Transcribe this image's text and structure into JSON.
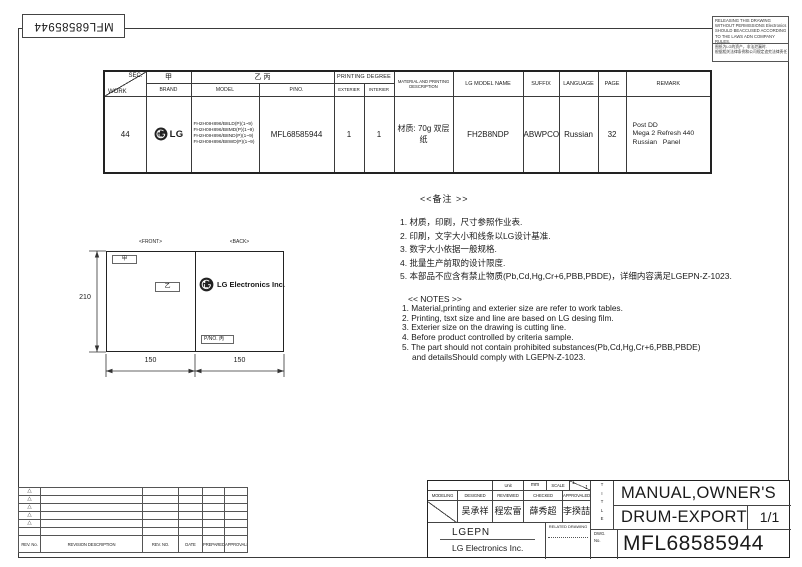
{
  "page": {
    "part_number_top": "MFL68585944"
  },
  "warning_box": {
    "en_lines": [
      "RELEASING THIS DRAWING",
      "WITHOUT PERMISSIONS Electronics",
      "SHOULD BEACCUSED ACCORDING",
      "TO THE LAWS ADN COMPANY",
      "RULES."
    ],
    "cn_lines": [
      "图纸为LG的资产，非法泄漏时.",
      "根据相关法律条例和公司规定追究法律责任"
    ]
  },
  "spec_table": {
    "corner_top": "SEC.",
    "corner_bottom": "WORK",
    "brand_cn": "甲",
    "model_pno_cn": "乙 丙",
    "brand_label": "BRAND",
    "model_label": "MODEL",
    "pno_label": "P/NO.",
    "printing_degree_label": "PRINTING DEGREE",
    "exterier_label": "EXTERIER",
    "interier_label": "INTERIER",
    "material_label": "MATERIAL AND PRINTING DESCRIPTION",
    "lg_model_label": "LG MODEL NAME",
    "suffix_label": "SUFFIX",
    "language_label": "LANGUAGE",
    "page_label": "PAGE",
    "remark_label": "REMARK",
    "row": {
      "work": "44",
      "brand": "LG",
      "models": [
        "FH2H0IH896/B8LD(P)(1~9)",
        "FH2H0IH896/B8MD(P)(1~9)",
        "FH2H0IH896/B8ND(P)(1~9)",
        "FH2H0IH896/B8WD(P)(1~9)"
      ],
      "pno": "MFL68585944",
      "exterier": "1",
      "interier": "1",
      "material": "材质: 70g 双层纸",
      "lg_model_name": "FH2B8NDP",
      "suffix": "ABWPCOM",
      "language": "Russian",
      "page": "32",
      "remark_lines": [
        "Post DD",
        "Mega 2 Refresh 440",
        "Russian   Panel"
      ]
    }
  },
  "diagram": {
    "front_label": "<FRONT>",
    "back_label": "<BACK>",
    "dim_height": "210",
    "dim_width_left": "150",
    "dim_width_right": "150",
    "tag_front_top": "甲",
    "tag_front_mid": "乙",
    "back_company": "LG Electronics Inc.",
    "back_pno": "P/NO. 丙"
  },
  "notes_cn": {
    "title": "<<备注 >>",
    "items": [
      "1.  材质，印刷，尺寸参照作业表.",
      "2.  印刷，文字大小和线条以LG设计基准.",
      "3.  数字大小依据一般规格.",
      "4.  批量生产前取的设计限度.",
      "5.  本部品不应含有禁止物质(Pb,Cd,Hg,Cr+6,PBB,PBDE)，详细内容满足LGEPN-Z-1023."
    ]
  },
  "notes_en": {
    "title": "<< NOTES >>",
    "items": [
      "1. Material,printing and exterier size are refer to work tables.",
      "2. Printing, tsxt  size and line are based on LG desing film.",
      "3. Exterier size on the drawing is cutting line.",
      "4. Before product controlled by criteria sample.",
      "5. The part should not contain prohibited substances(Pb,Cd,Hg,Cr+6,PBB,PBDE)",
      "and detailsShould comply with LGEPN-Z-1023."
    ]
  },
  "revision_table": {
    "marker": "△",
    "headers": [
      "REV. No.",
      "REVISION DESCRIPTION",
      "REV. NO.",
      "DATE",
      "PREPARED",
      "APPROVALED"
    ]
  },
  "title_block": {
    "unit_label": "Unit",
    "unit_value": "mm",
    "scale_label": "SCALE",
    "scale_top": "1",
    "scale_bottom": "1",
    "role_labels": [
      "MODELING",
      "DESIGNED",
      "REVIEWED",
      "CHECKED",
      "APPROVALED"
    ],
    "names": [
      "吴承祥",
      "程宏雷",
      "薛秀超",
      "李揆喆"
    ],
    "company_code": "LGEPN",
    "company_name": "LG Electronics Inc.",
    "related_drawing_label": "RELATED DRAWING",
    "title_label_vertical": [
      "T",
      "I",
      "T",
      "L",
      "E"
    ],
    "dwg_label_line1": "DWG.",
    "dwg_label_line2": "No.",
    "doc_title_line1": "MANUAL,OWNER'S",
    "doc_title_line2": "DRUM-EXPORT",
    "sheet": "1/1",
    "dwg_no": "MFL68585944"
  },
  "colors": {
    "line": "#3a3a3a",
    "text": "#1a1a1a",
    "logo": "#222222"
  }
}
